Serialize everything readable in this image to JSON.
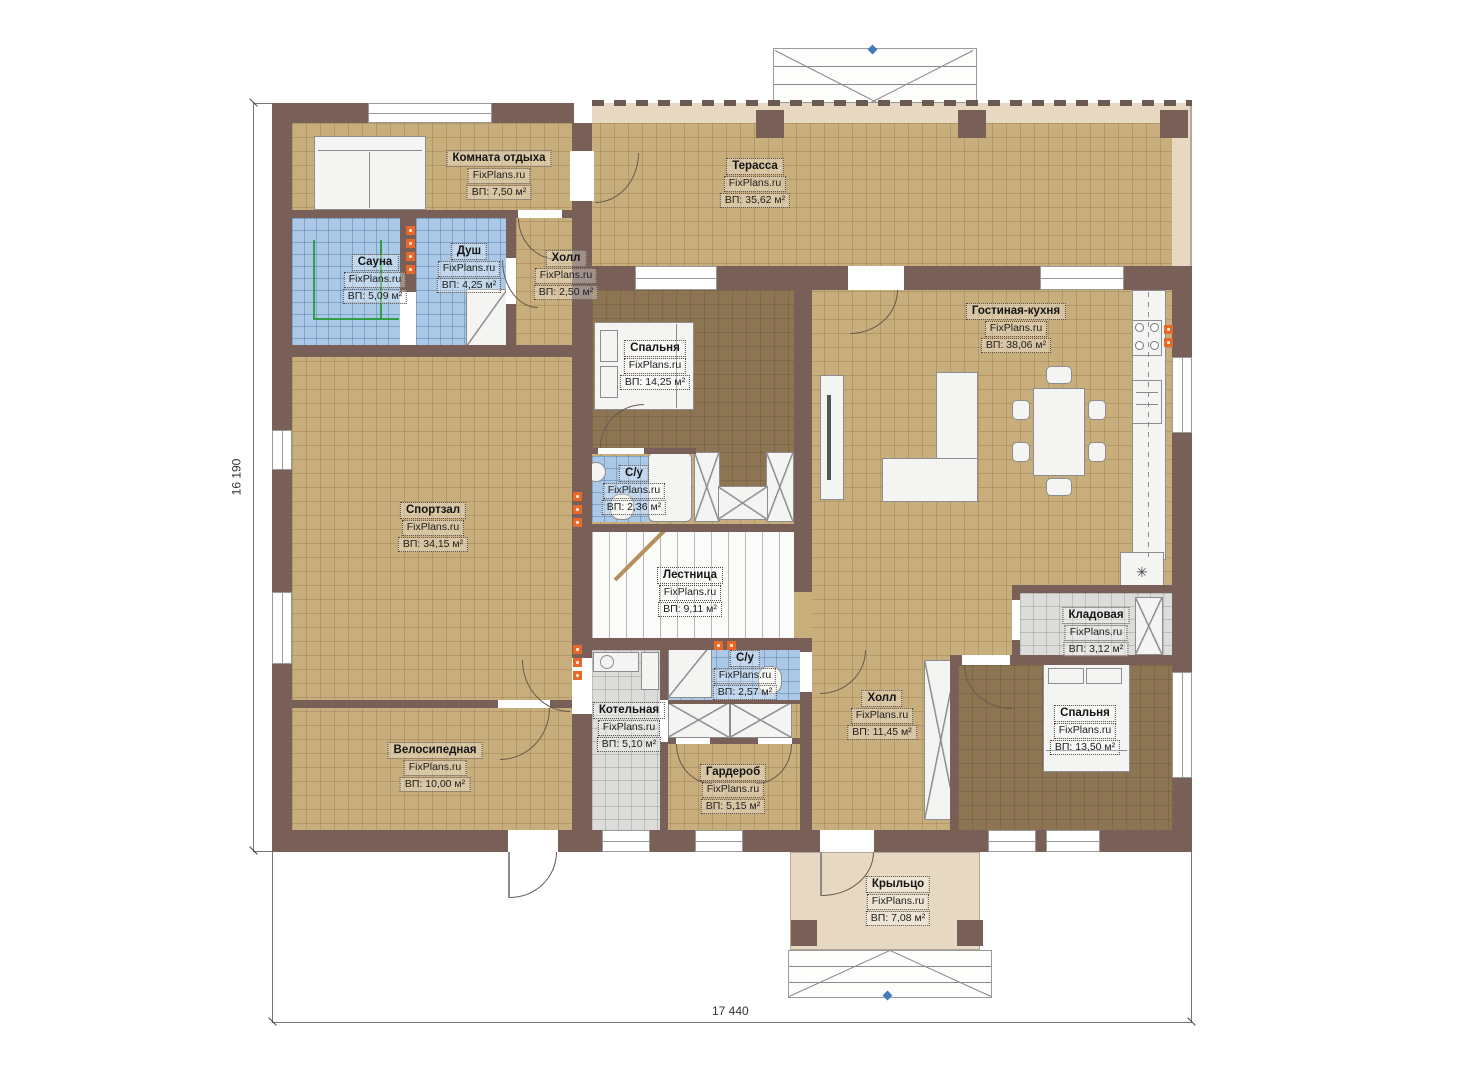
{
  "brand": "FixPlans.ru",
  "dimensions": {
    "left": "16 190",
    "bottom": "17 440"
  },
  "rooms": [
    {
      "name": "Комната отдыха",
      "area": "ВП: 7,50 м²"
    },
    {
      "name": "Терасса",
      "area": "ВП: 35,62 м²"
    },
    {
      "name": "Сауна",
      "area": "ВП: 5,09 м²"
    },
    {
      "name": "Душ",
      "area": "ВП: 4,25 м²"
    },
    {
      "name": "Холл",
      "area": "ВП: 2,50 м²"
    },
    {
      "name": "Спальня",
      "area": "ВП: 14,25 м²"
    },
    {
      "name": "Гостиная-кухня",
      "area": "ВП: 38,06 м²"
    },
    {
      "name": "Спортзал",
      "area": "ВП: 34,15 м²"
    },
    {
      "name": "С/у",
      "area": "ВП: 2,36 м²"
    },
    {
      "name": "Лестница",
      "area": "ВП: 9,11 м²"
    },
    {
      "name": "Кладовая",
      "area": "ВП: 3,12 м²"
    },
    {
      "name": "С/у",
      "area": "ВП: 2,57 м²"
    },
    {
      "name": "Холл",
      "area": "ВП: 11,45 м²"
    },
    {
      "name": "Котельная",
      "area": "ВП: 5,10 м²"
    },
    {
      "name": "Спальня",
      "area": "ВП: 13,50 м²"
    },
    {
      "name": "Велосипедная",
      "area": "ВП: 10,00 м²"
    },
    {
      "name": "Гардероб",
      "area": "ВП: 5,15 м²"
    },
    {
      "name": "Крыльцо",
      "area": "ВП: 7,08 м²"
    }
  ],
  "symbols": {
    "snowflake": "✳"
  },
  "colors": {
    "wall": "#786058",
    "floor_tile": "#c9ae7d",
    "floor_wood": "#8d7554",
    "floor_wet": "#abc8e6",
    "floor_tech": "#dcdcda",
    "outdoor": "#e7d8c1",
    "heater": "#e8682a",
    "marker": "#4679bd",
    "sauna_bench": "#2f9e44"
  }
}
